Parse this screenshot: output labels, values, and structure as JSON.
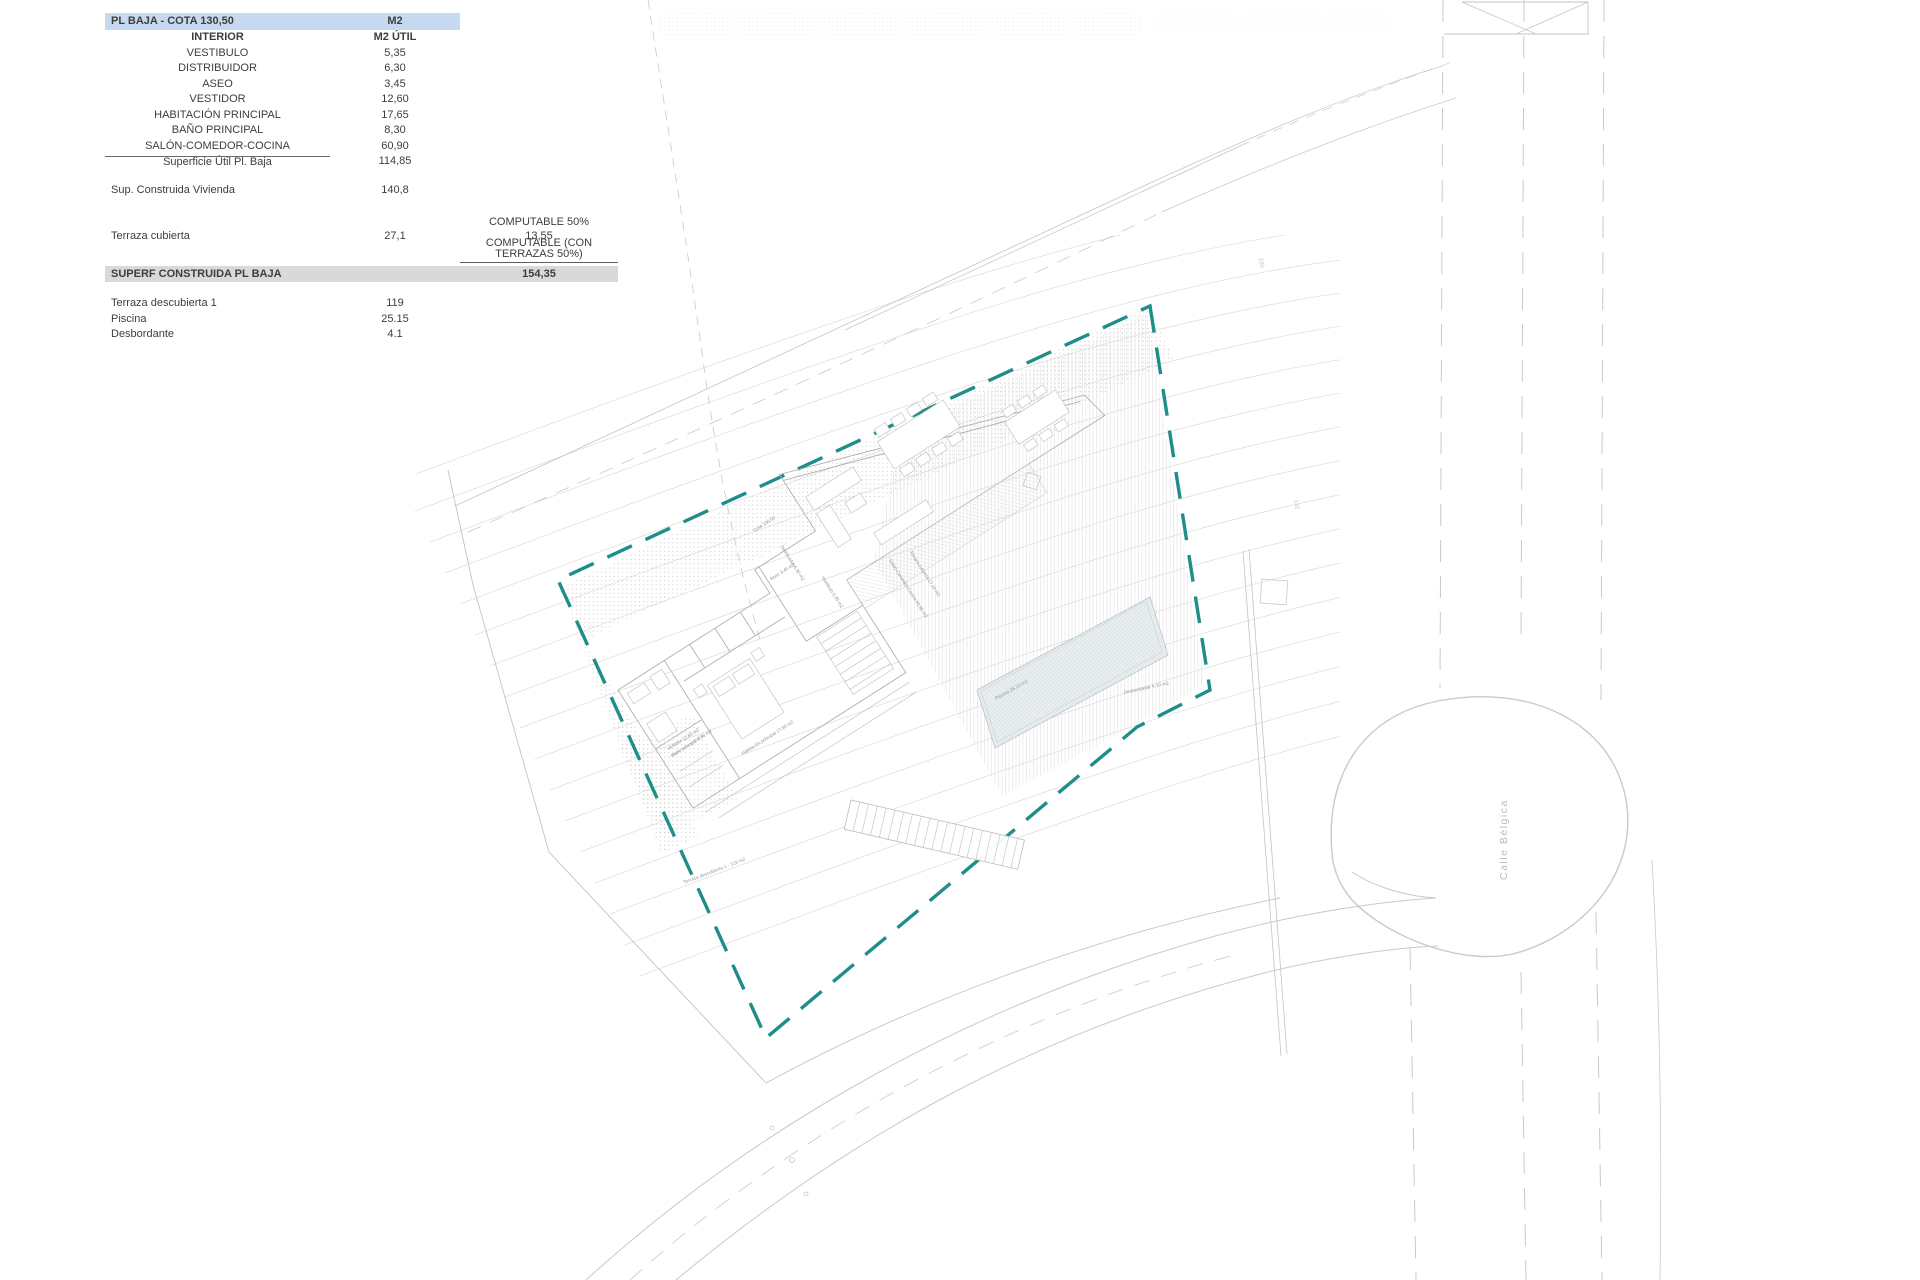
{
  "table": {
    "header": {
      "label": "PL BAJA - COTA 130,50",
      "value": "M2"
    },
    "subheader": {
      "label": "INTERIOR",
      "value": "M2 ÚTIL"
    },
    "rooms": [
      {
        "label": "VESTIBULO",
        "value": "5,35"
      },
      {
        "label": "DISTRIBUIDOR",
        "value": "6,30"
      },
      {
        "label": "ASEO",
        "value": "3,45"
      },
      {
        "label": "VESTIDOR",
        "value": "12,60"
      },
      {
        "label": "HABITACIÓN PRINCIPAL",
        "value": "17,65"
      },
      {
        "label": "BAÑO PRINCIPAL",
        "value": "8,30"
      },
      {
        "label": "SALÓN-COMEDOR-COCINA",
        "value": "60,90"
      }
    ],
    "subtotal": {
      "label": "Superficie Útil Pl. Baja",
      "value": "114,85"
    },
    "construida": {
      "label": "Sup. Construida Vivienda",
      "value": "140,8"
    },
    "computable": {
      "title": "COMPUTABLE 50%",
      "value": "13,55",
      "note": "COMPUTABLE (CON TERRAZAS 50%)"
    },
    "terraza": {
      "label": "Terraza cubierta",
      "value": "27,1"
    },
    "banner": {
      "label": "SUPERF CONSTRUIDA PL BAJA",
      "value": "154,35"
    },
    "extras": [
      {
        "label": "Terraza descubierta 1",
        "value": "119"
      },
      {
        "label": "Piscina",
        "value": "25.15"
      },
      {
        "label": "Desbordante",
        "value": "4.1"
      }
    ]
  },
  "plan": {
    "street": "Calle Bélgica",
    "labels": {
      "piscina": "Piscina 25,15 m2",
      "desbordante": "Desbordante 4,10 m2",
      "terraza_descubierta": "Terraza descubierta 1 - 119 m2",
      "habitacion": "Habitación principal 17,65 m2",
      "bano": "Baño principal 8,30 m2",
      "vestidor": "Vestidor 12,60 m2",
      "aseo": "Aseo 3,45 m2",
      "distribuidor": "Distribuidor 6,30 m2",
      "vestibulo": "Vestíbulo 5,35 m2",
      "salon": "Salón-Comedor-Cocina 60,90 m2",
      "terraza_cubierta": "Terraza cubierta 27,10 m2",
      "cota": "Cota 130,50"
    },
    "contour_labels": [
      "130",
      "132"
    ],
    "colors": {
      "boundary_teal": "#1f8e89",
      "header_blue": "#c6d9f0",
      "banner_gray": "#d9d9d9",
      "pool_fill": "#e8edf0",
      "line_gray": "#c3c3c3",
      "contour_gray": "#dcdcdc"
    }
  }
}
